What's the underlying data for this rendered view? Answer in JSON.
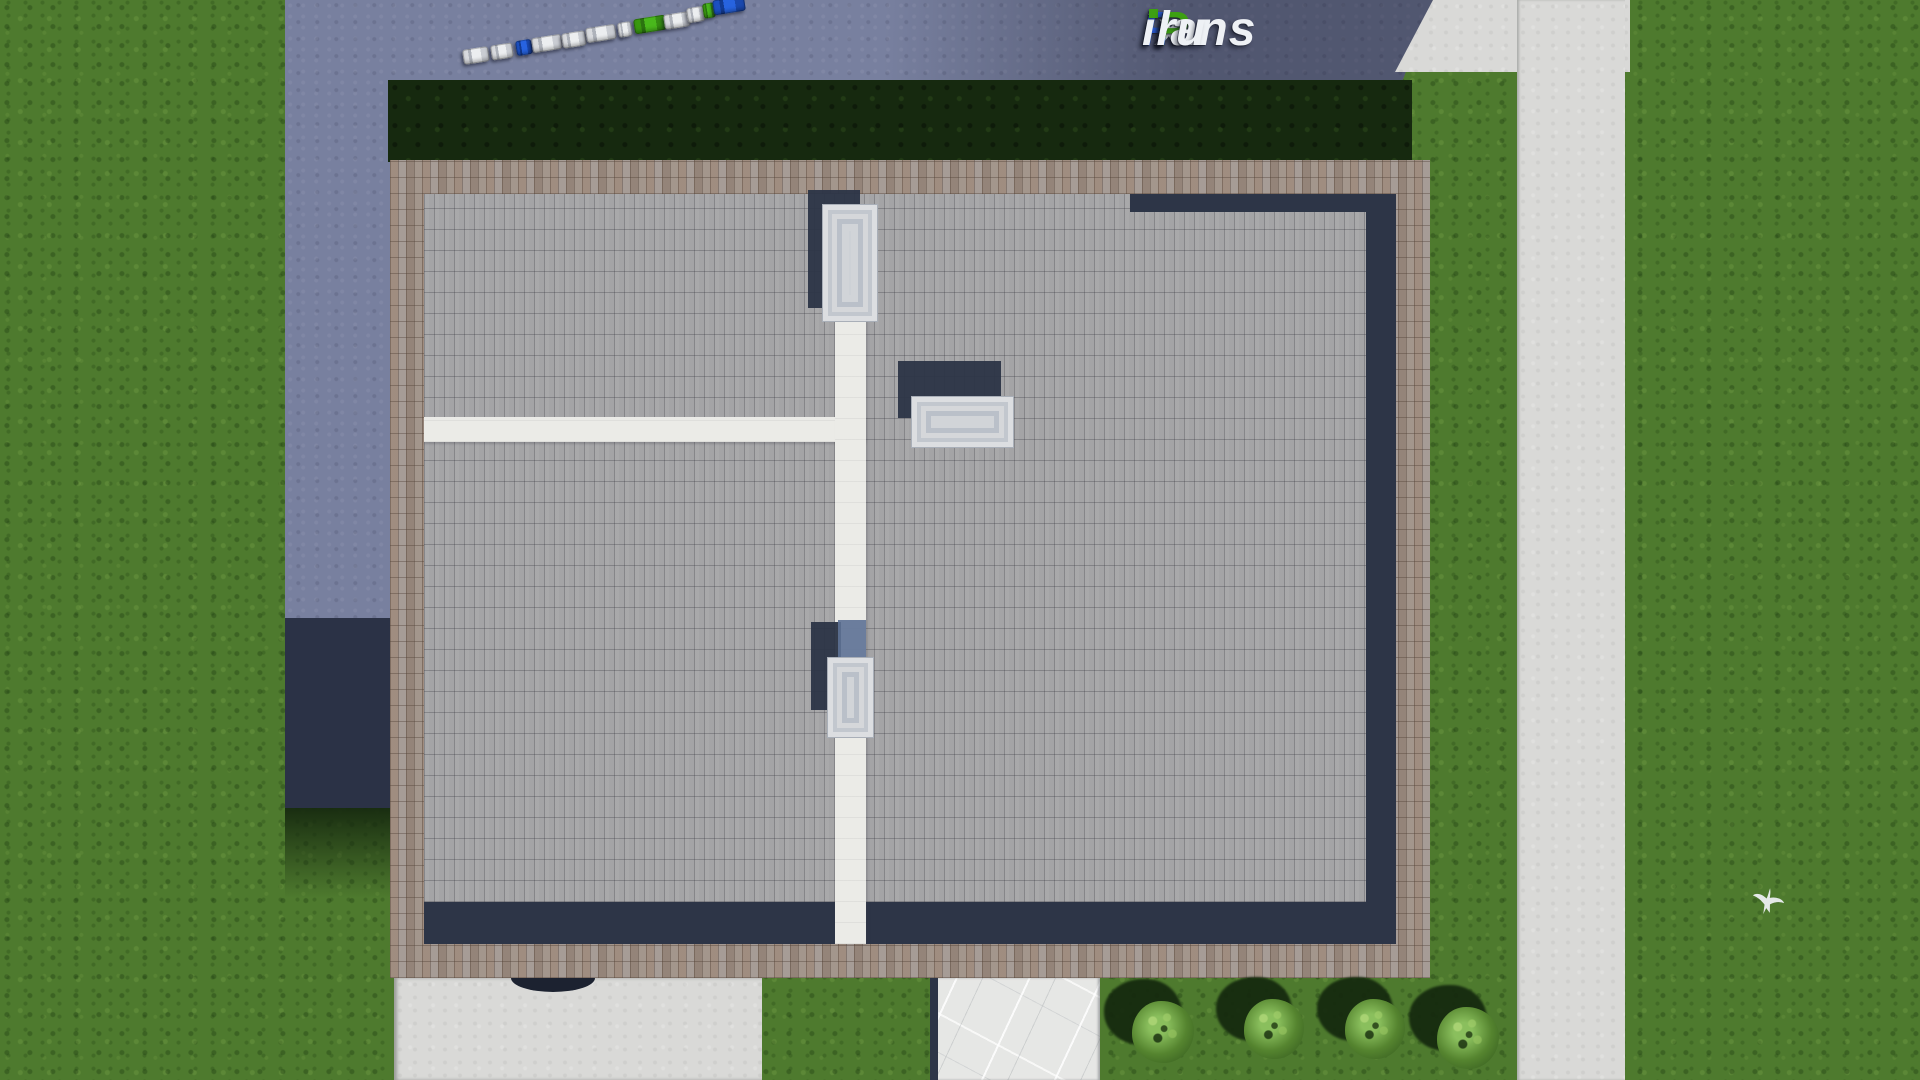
{
  "logo": {
    "full_text": "FixPlans.ru",
    "segments": [
      {
        "text": "F",
        "color_key": "logo_blue"
      },
      {
        "text": "i",
        "color_key": "logo_white"
      },
      {
        "text": "x",
        "color_key": "logo_white"
      },
      {
        "text": "P",
        "color_key": "logo_green"
      },
      {
        "text": "lans",
        "color_key": "logo_white"
      },
      {
        "text": ".",
        "color_key": "logo_blue"
      },
      {
        "text": "ru",
        "color_key": "logo_white"
      }
    ]
  },
  "colors": {
    "grass": "#4e7a2e",
    "grass_dark": "#16290f",
    "asphalt": "#78809f",
    "asphalt_dark": "#2b3246",
    "concrete": "#d9d9d7",
    "marble": "#e6e7e5",
    "brick": "#a3968c",
    "roof": "#a4a4a6",
    "navy": "#2d3547",
    "path_white": "#ebebe7",
    "skylight": "#cdd1d6",
    "shadow_green": "#14280e",
    "shadow_blue_light": "#5d7195",
    "bush": "#55842f",
    "bush_light": "#8abf5d",
    "logo_blue": "#2a5ad0",
    "logo_green": "#3da012",
    "logo_white": "#eef1f5",
    "car_white": "#e9eaec",
    "car_blue": "#1d56cc",
    "car_green": "#3da315"
  },
  "street": {
    "cars": [
      {
        "x": 476,
        "y": 56,
        "w": 26,
        "color": "white"
      },
      {
        "x": 502,
        "y": 52,
        "w": 22,
        "color": "white"
      },
      {
        "x": 524,
        "y": 48,
        "w": 16,
        "color": "blue"
      },
      {
        "x": 547,
        "y": 44,
        "w": 30,
        "color": "white"
      },
      {
        "x": 574,
        "y": 40,
        "w": 24,
        "color": "white"
      },
      {
        "x": 601,
        "y": 34,
        "w": 30,
        "color": "white"
      },
      {
        "x": 625,
        "y": 30,
        "w": 14,
        "color": "white"
      },
      {
        "x": 650,
        "y": 25,
        "w": 32,
        "color": "green"
      },
      {
        "x": 677,
        "y": 21,
        "w": 26,
        "color": "white"
      },
      {
        "x": 696,
        "y": 15,
        "w": 18,
        "color": "white"
      },
      {
        "x": 709,
        "y": 11,
        "w": 12,
        "color": "green"
      },
      {
        "x": 729,
        "y": 6,
        "w": 32,
        "color": "blue"
      }
    ]
  },
  "garden": {
    "bushes": [
      {
        "x": 1163,
        "y": 1032,
        "r": 31
      },
      {
        "x": 1274,
        "y": 1029,
        "r": 30
      },
      {
        "x": 1375,
        "y": 1029,
        "r": 30
      },
      {
        "x": 1468,
        "y": 1038,
        "r": 31
      }
    ],
    "bird": {
      "x": 1768,
      "y": 903
    }
  }
}
